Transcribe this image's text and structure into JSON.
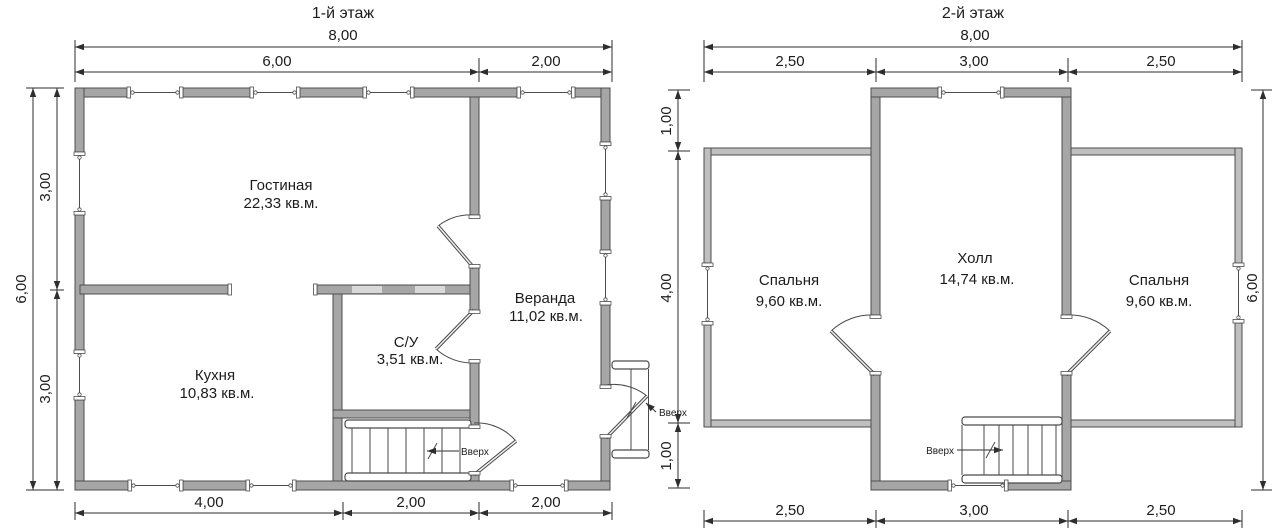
{
  "floor1": {
    "title": "1-й этаж",
    "rooms": {
      "living": {
        "name": "Гостиная",
        "area": "22,33 кв.м."
      },
      "veranda": {
        "name": "Веранда",
        "area": "11,02 кв.м."
      },
      "bathroom": {
        "name": "С/У",
        "area": "3,51 кв.м."
      },
      "kitchen": {
        "name": "Кухня",
        "area": "10,83 кв.м."
      }
    },
    "dims": {
      "width_total": "8,00",
      "width_main": "6,00",
      "width_veranda": "2,00",
      "height_total": "6,00",
      "height_upper": "3,00",
      "height_lower": "3,00",
      "bottom_kitchen": "4,00",
      "bottom_stairs": "2,00",
      "bottom_veranda": "2,00"
    },
    "labels": {
      "stairs_up": "Вверх",
      "entry_up": "Вверх"
    }
  },
  "floor2": {
    "title": "2-й этаж",
    "rooms": {
      "bedroom_left": {
        "name": "Спальня",
        "area": "9,60 кв.м."
      },
      "hall": {
        "name": "Холл",
        "area": "14,74 кв.м."
      },
      "bedroom_right": {
        "name": "Спальня",
        "area": "9,60 кв.м."
      }
    },
    "dims": {
      "width_total": "8,00",
      "width_left": "2,50",
      "width_mid": "3,00",
      "width_right": "2,50",
      "height_total": "6,00",
      "height_top": "1,00",
      "height_mid": "4,00",
      "height_bottom": "1,00",
      "bottom_left": "2,50",
      "bottom_mid": "3,00",
      "bottom_right": "2,50"
    },
    "labels": {
      "stairs_up": "Вверх"
    }
  }
}
